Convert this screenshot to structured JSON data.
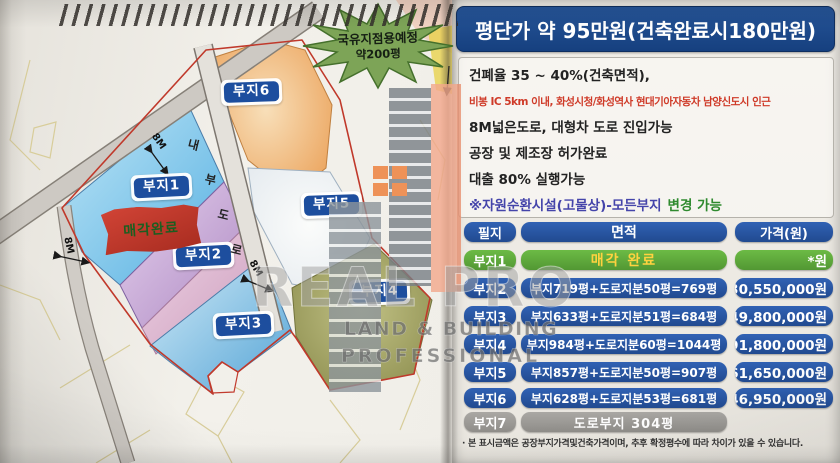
{
  "title": "평단가 약 95만원(건축완료시180만원)",
  "info": {
    "lines": [
      {
        "text": "건폐율 35 ~ 40%(건축면적),"
      },
      {
        "text": "비봉 IC 5km 이내, 화성시청/화성역사 현대기아자동차 남양신도시 인근"
      },
      {
        "text": "8M넓은도로, 대형차 도로 진입가능"
      },
      {
        "text": "공장 및 제조장 허가완료"
      },
      {
        "text": "대출 80% 실행가능"
      }
    ],
    "note": {
      "part1": "※자원순환시설(고물상)-모든부지",
      "part2": "변경 가능"
    }
  },
  "table": {
    "headers": [
      "필지",
      "면적",
      "가격(원)"
    ],
    "rows": [
      {
        "plot": "부지1",
        "area": "매각 완료",
        "price": "*원"
      },
      {
        "plot": "부지2",
        "area": "부지719평+도로지분50평=769평",
        "price": "730,550,000원"
      },
      {
        "plot": "부지3",
        "area": "부지633평+도로지분51평=684평",
        "price": "649,800,000원"
      },
      {
        "plot": "부지4",
        "area": "부지984평+도로지분60평=1044평",
        "price": "991,800,000원"
      },
      {
        "plot": "부지5",
        "area": "부지857평+도로지분50평=907평",
        "price": "861,650,000원"
      },
      {
        "plot": "부지6",
        "area": "부지628평+도로지분53평=681평",
        "price": "646,950,000원"
      },
      {
        "plot": "부지7",
        "area": "도로부지 304평",
        "price": ""
      }
    ]
  },
  "footnote": "· 본 표시금액은 공장부지가격및건축가격이며, 추후 확정평수에 따라 차이가 있을 수 있습니다.",
  "map": {
    "starburst": {
      "line1": "국유지점용예정",
      "line2": "약200평"
    },
    "flag_text": "매각완료",
    "plots": {
      "p1": "부지1",
      "p2": "부지2",
      "p3": "부지3",
      "p4": "부지4",
      "p5": "부지5",
      "p6": "부지6"
    },
    "road_chars": [
      "내",
      "부",
      "도",
      "로"
    ],
    "dims": [
      "8M",
      "8M",
      "8M"
    ]
  },
  "watermark": {
    "line1": "REAL PRO",
    "line2": "LAND & BUILDING",
    "line3": "PROFESSIONAL"
  },
  "colors": {
    "title_bg": "#1d4b95",
    "pill_blue": "#2a58aa",
    "sold_green": "#5fae3e",
    "road_gray": "#9f9d99",
    "accent_red": "#cf3a28",
    "flag_red": "#c0392b",
    "star_green": "#7da457",
    "note_blue": "#4444aa",
    "note_green": "#2f8a2f",
    "sold_text": "#ffd23f"
  }
}
